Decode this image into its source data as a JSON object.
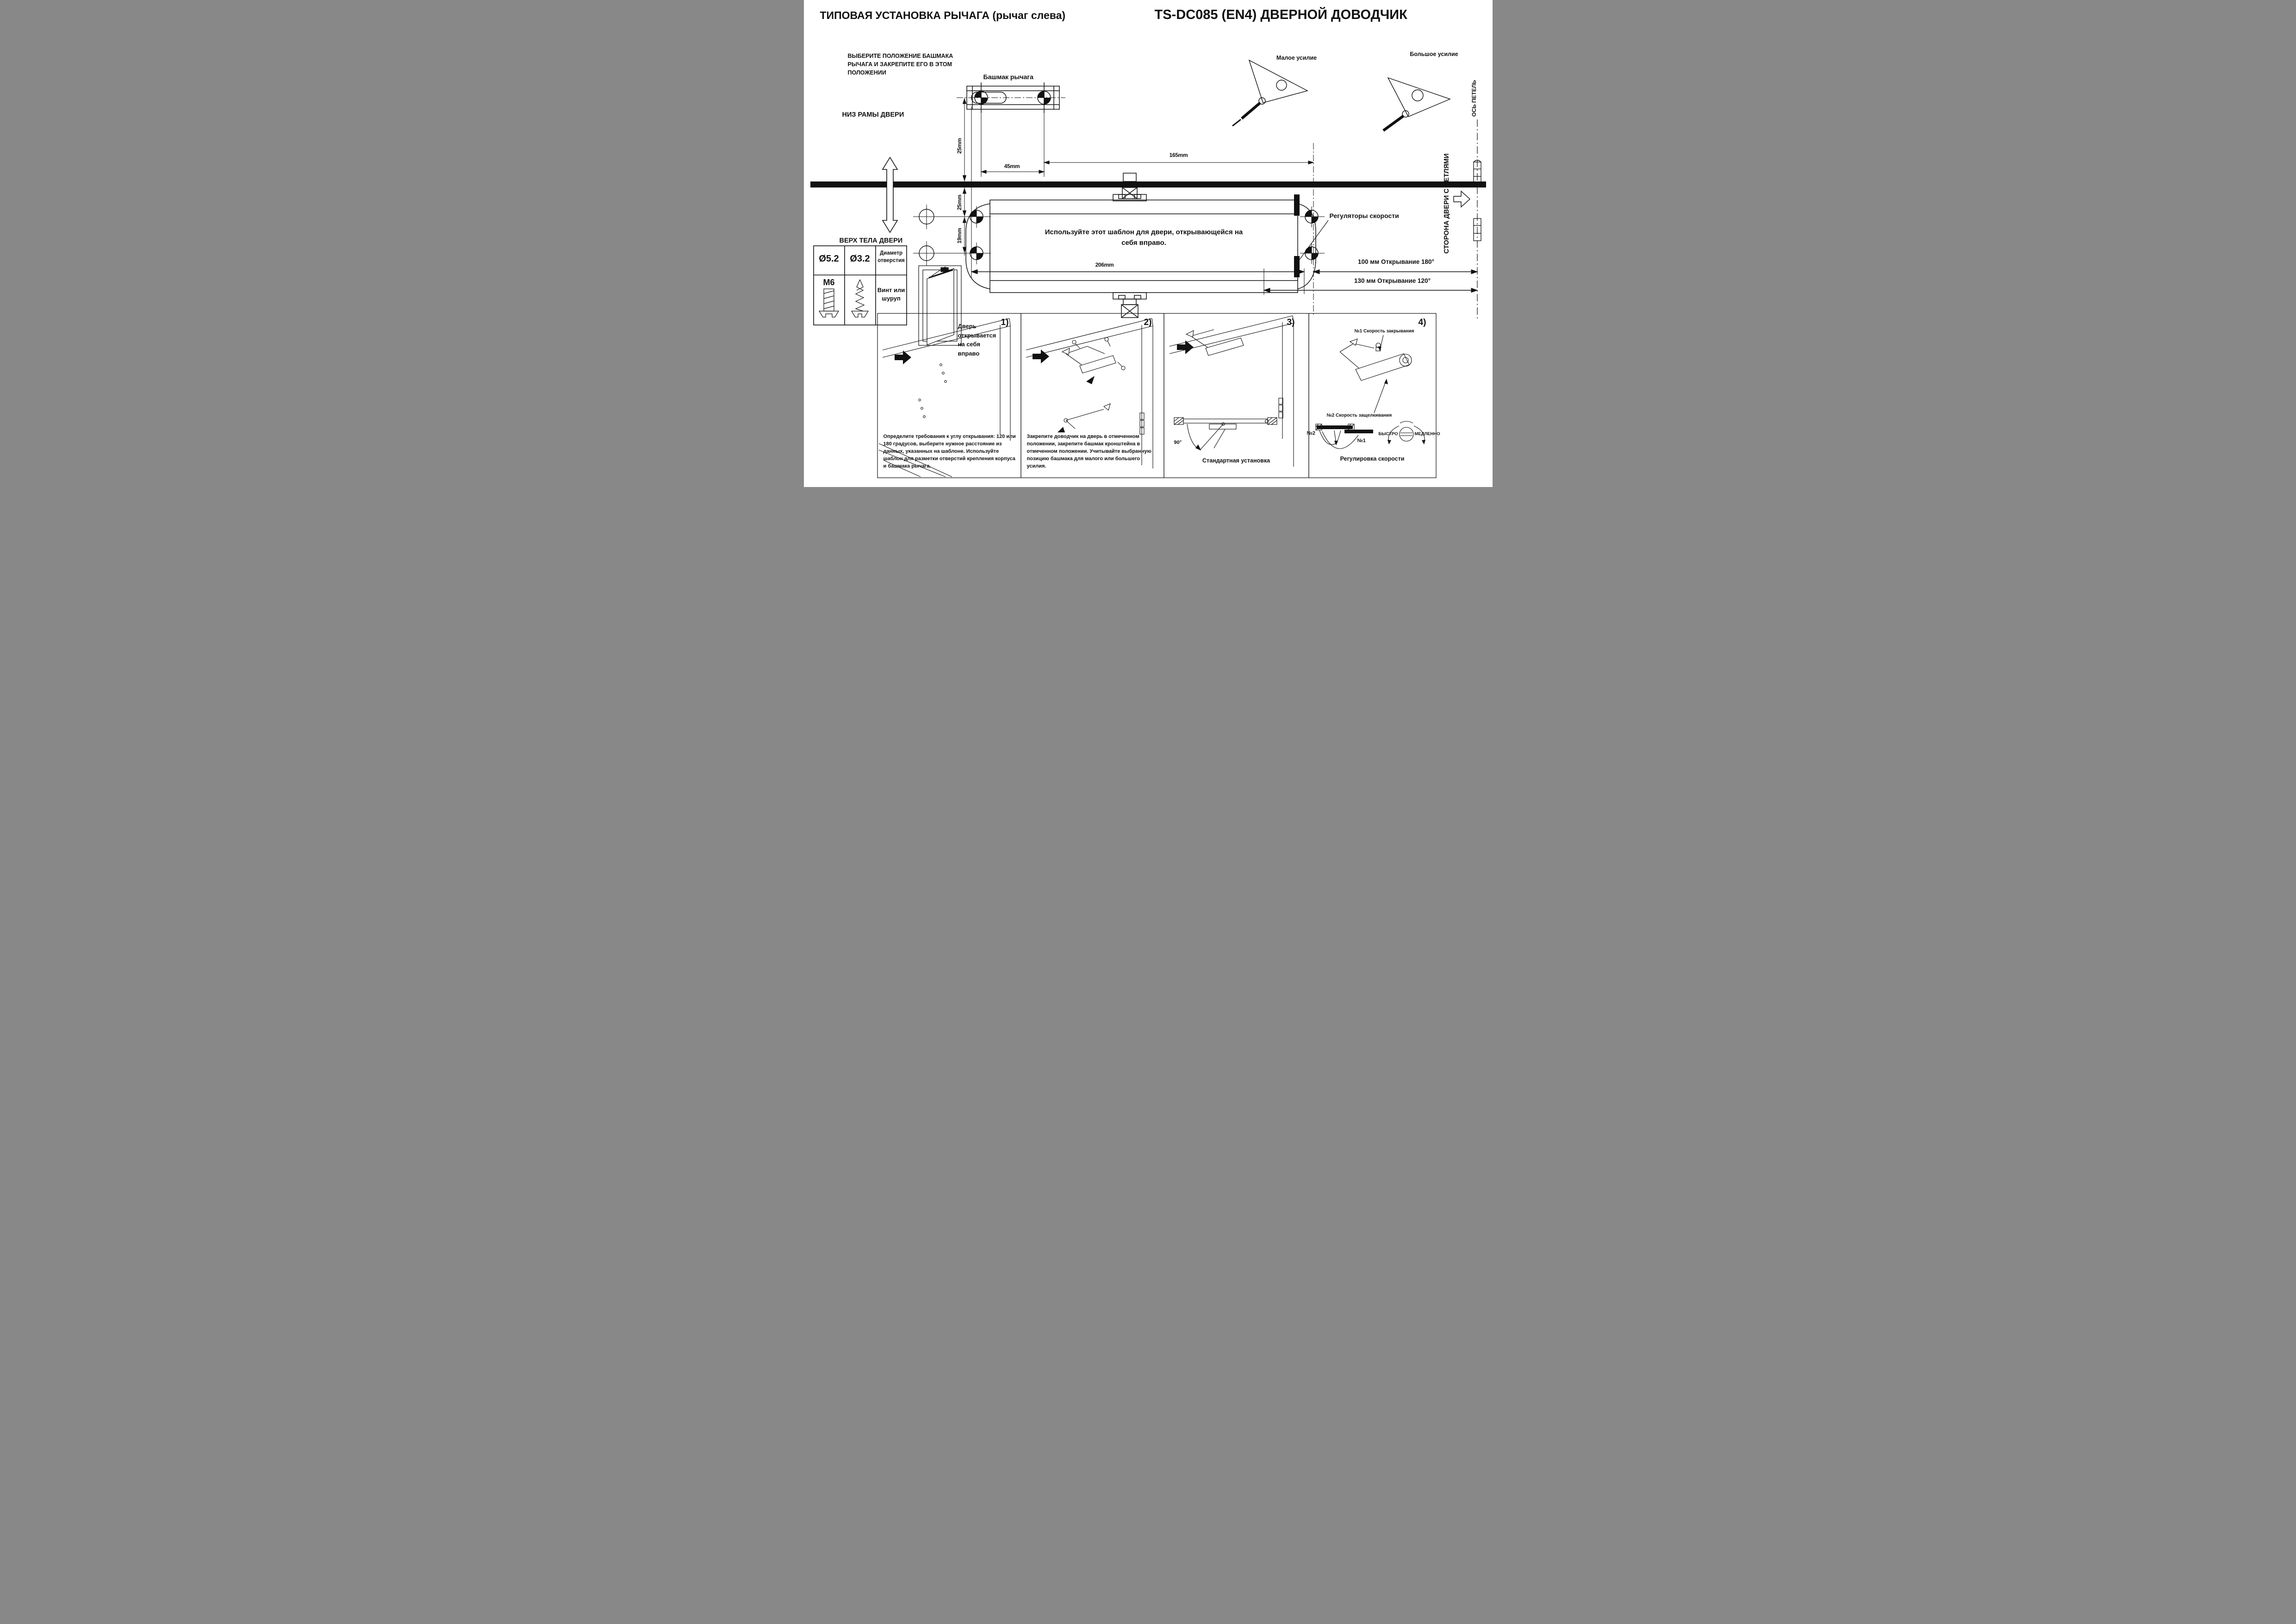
{
  "header": {
    "title_left": "ТИПОВАЯ УСТАНОВКА РЫЧАГА (рычаг слева)",
    "title_right": "TS-DC085 (EN4) ДВЕРНОЙ ДОВОДЧИК"
  },
  "notes": {
    "select_position": "ВЫБЕРИТЕ ПОЛОЖЕНИЕ БАШМАКА РЫЧАГА И ЗАКРЕПИТЕ ЕГО В ЭТОМ ПОЛОЖЕНИИ",
    "frame_bottom": "НИЗ РАМЫ ДВЕРИ",
    "door_body_top": "ВЕРХ ТЕЛА ДВЕРИ",
    "template_note": "Используйте этот шаблон для двери, открывающейся на себя вправо.",
    "door_opens_right": "Дверь открывается на себя вправо",
    "arm_shoe": "Башмак рычага",
    "small_force": "Малое усилие",
    "big_force": "Большое усилие",
    "speed_regulators": "Регуляторы скорости",
    "hinge_side": "СТОРОНА ДВЕРИ С ПЕТЛЯМИ",
    "hinge_axis": "ОСЬ ПЕТЕЛЬ"
  },
  "dims": {
    "d45": "45mm",
    "d165": "165mm",
    "d206": "206mm",
    "d25_top": "25mm",
    "d25_bottom": "25mm",
    "d19": "19mm",
    "open180": "100 мм   Открывание 180°",
    "open120": "130 мм   Открывание 120°"
  },
  "legend_table": {
    "hole_big": "Ø5.2",
    "hole_small": "Ø3.2",
    "hole_title": "Диаметр отверстия",
    "bolt": "M6",
    "screw_title": "Винт или шуруп"
  },
  "panels": {
    "p1": {
      "num": "1)",
      "text": "Определите требования к углу открывания: 120 или 180 градусов, выберите нужное расстояние из данных, указанных на шаблоне. Используйте шаблон для разметки отверстий крепления корпуса и башмака рычага."
    },
    "p2": {
      "num": "2)",
      "text": "Закрепите доводчик на дверь в отмеченном положении, закрепите башмак кронштейна в отмеченном положении. Учитывайте выбранную позицию башмака для малого или большего усилия."
    },
    "p3": {
      "num": "3)",
      "caption": "Стандартная установка",
      "angle": "90°"
    },
    "p4": {
      "num": "4)",
      "caption": "Регулировка скорости",
      "label_speed_close": "№1 Скорость закрывания",
      "label_speed_latch": "№2 Скорость защелкивания",
      "n1": "№1",
      "n2": "№2",
      "fast": "БЫСТРО",
      "slow": "МЕДЛЕННО"
    }
  }
}
